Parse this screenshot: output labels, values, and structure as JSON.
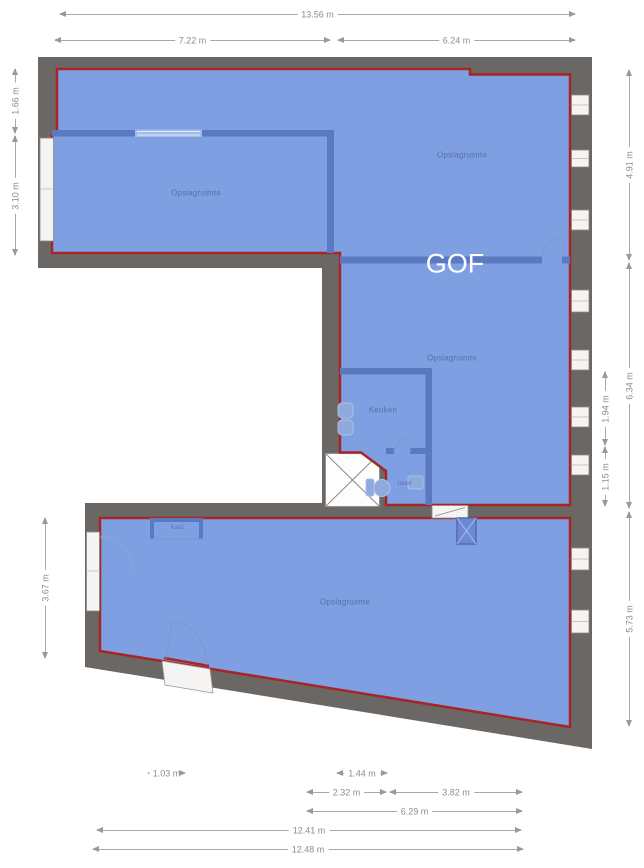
{
  "floor_label": "GOF",
  "rooms": {
    "top_left": {
      "label": "Opslagruimte"
    },
    "top_right": {
      "label": "Opslagruimte"
    },
    "middle": {
      "label": "Opslagruimte"
    },
    "kitchen": {
      "label": "Keuken"
    },
    "toilet": {
      "label": "Toilet"
    },
    "closet": {
      "label": "Kast"
    },
    "bottom": {
      "label": "Opslagruimte"
    }
  },
  "dimensions": {
    "top_total": "13.56 m",
    "top_left_segment": "7.22 m",
    "top_right_segment": "6.24 m",
    "left_top": "1.66 m",
    "left_middle": "3.10 m",
    "left_bottom": "3.67 m",
    "right_top": "4.91 m",
    "right_middle": "6.34 m",
    "right_inner_top": "1.94 m",
    "right_inner_bottom": "1.15 m",
    "right_bottom": "5.73 m",
    "bottom_seg_small": "1.03 m",
    "bottom_seg_1": "1.44 m",
    "bottom_seg_2": "2.32 m",
    "bottom_seg_3": "3.82 m",
    "bottom_seg_4": "6.29 m",
    "bottom_total_inner": "12.41 m",
    "bottom_total_outer": "12.48 m"
  },
  "colors": {
    "room_fill": "#7f9fe3",
    "unit_outline": "#a82524",
    "outer_wall": "#6b6764",
    "inner_wall": "#5b79c0",
    "dimension_text": "#8c8c8c"
  }
}
